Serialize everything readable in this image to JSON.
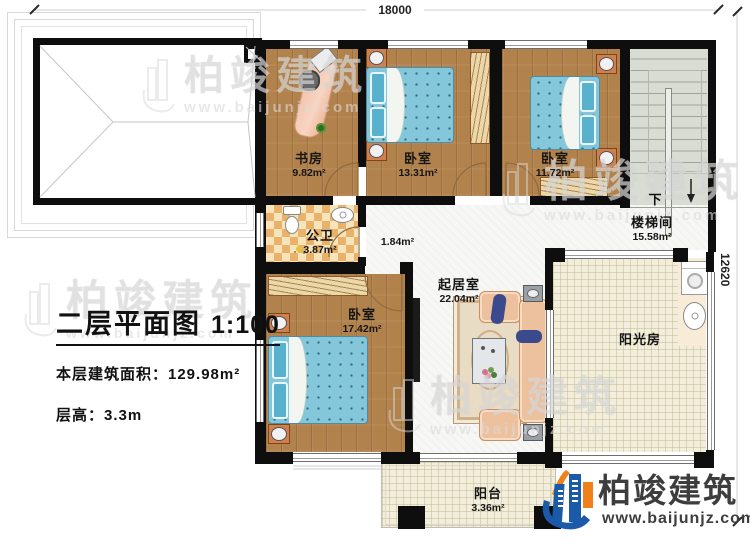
{
  "title_block": {
    "title": "二层平面图",
    "scale": "1:100",
    "area_text": "本层建筑面积：129.98m²",
    "height_text": "层高：3.3m"
  },
  "dimensions": {
    "top_width": "18000",
    "right_height": "12620"
  },
  "rooms": {
    "study": {
      "name": "书房",
      "area": "9.82m²"
    },
    "bedroom_mid": {
      "name": "卧室",
      "area": "13.31m²"
    },
    "bedroom_right": {
      "name": "卧室",
      "area": "11.72m²"
    },
    "stairwell": {
      "name": "楼梯间",
      "area": "15.58m²",
      "down": "下"
    },
    "bathroom": {
      "name": "公卫",
      "area": "3.87m²"
    },
    "hallway": {
      "area": "1.84m²"
    },
    "living": {
      "name": "起居室",
      "area": "22.04m²"
    },
    "bedroom_left": {
      "name": "卧室",
      "area": "17.42m²"
    },
    "sunroom": {
      "name": "阳光房"
    },
    "balcony": {
      "name": "阳台",
      "area": "3.36m²"
    }
  },
  "branding": {
    "company": "柏竣建筑",
    "website": "www.baijunjz.com"
  },
  "watermark": {
    "company": "柏竣建筑",
    "website": "www.baijunjz.com"
  },
  "colors": {
    "wall": "#0e0e0e",
    "wood_floor": "#b2824c",
    "bed_blue": "#84c7da",
    "bath_checker": "#eab269",
    "sunroom_floor": "#f2eedb",
    "stair_floor": "#d8dcd3",
    "logo_blue": "#1a5aa8",
    "logo_orange": "#f08019"
  }
}
